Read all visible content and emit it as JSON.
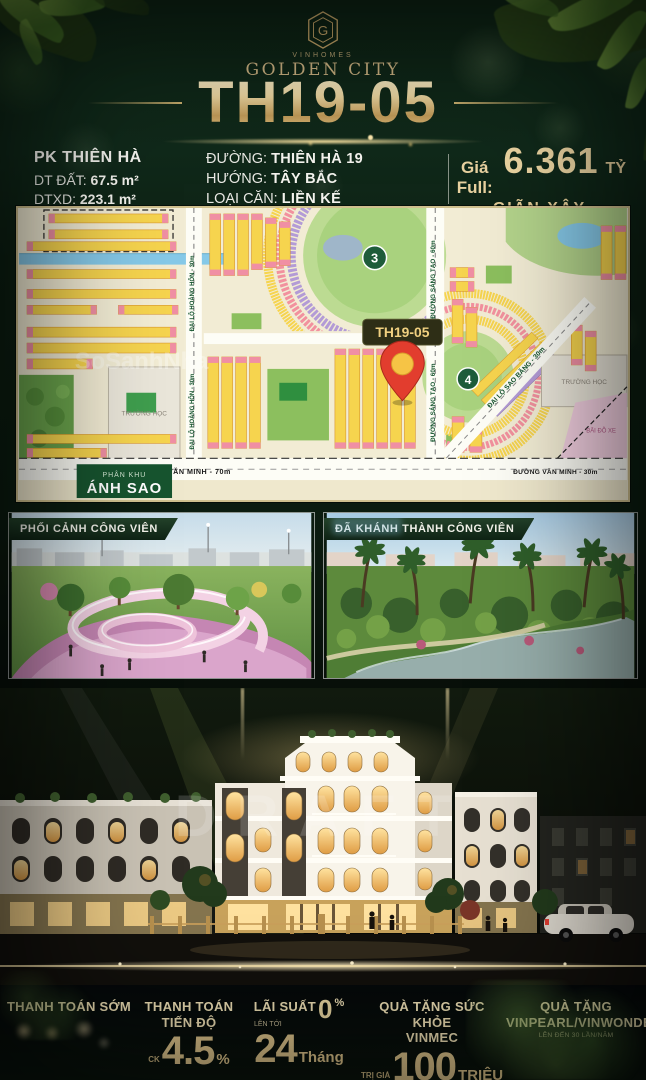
{
  "header": {
    "brand": "VINHOMES",
    "project": "GOLDEN CITY"
  },
  "title": "TH19-05",
  "info": {
    "zone": "PK THIÊN HÀ",
    "land_label": "DT ĐẤT:",
    "land_value": "67.5 m²",
    "build_label": "DTXD:",
    "build_value": "223.1 m²",
    "street_label": "ĐƯỜNG:",
    "street_value": "THIÊN HÀ 19",
    "direction_label": "HƯỚNG:",
    "direction_value": "TÂY BẮC",
    "type_label": "LOẠI CĂN:",
    "type_value": "LIỀN KẾ",
    "price_label": "Giá Full:",
    "price_value": "6.361",
    "price_unit": "TỶ",
    "price_note": "GIÃN XÂY"
  },
  "map": {
    "pin_label": "TH19-05",
    "zone_line1": "PHÂN KHU",
    "zone_line2": "ÁNH SAO",
    "park3": "3",
    "park4": "4",
    "road_van_minh_70": "ĐƯỜNG VĂN MINH - 70m",
    "road_van_minh_30": "ĐƯỜNG VĂN MINH - 30m",
    "road_sang_tao": "ĐƯỜNG SÁNG TẠO - 60m",
    "road_sao_bang": "ĐẠI LỘ SAO BĂNG - 30m",
    "road_hoang_hon": "ĐẠI LỘ HOÀNG HÔN - 30m",
    "school": "TRƯỜNG HỌC",
    "parking": "BÃI ĐỖ XE",
    "watermark": "SoSanhNha"
  },
  "cards": {
    "left_label": "PHỐI CẢNH CÔNG VIÊN",
    "right_label": "ĐÃ KHÁNH THÀNH CÔNG VIÊN"
  },
  "scene": {
    "watermark": "DRAFT"
  },
  "footer": {
    "col1_title": "THANH TOÁN SỚM",
    "col2_title1": "THANH TOÁN",
    "col2_title2": "TIẾN ĐỘ",
    "col2_prefix": "CK",
    "col2_big": "4.5",
    "col2_suffix": "%",
    "col3_title": "LÃI SUẤT",
    "col3_zero": "0",
    "col3_zero_pct": "%",
    "col3_small": "LÊN TỚI",
    "col3_big": "24",
    "col3_suffix": "Tháng",
    "col4_title1": "QUÀ TẶNG SỨC KHỎE",
    "col4_title2": "VINMEC",
    "col4_small": "TRỊ GIÁ",
    "col4_big": "100",
    "col4_suffix": "TRIỆU",
    "col5_title1": "QUÀ TẶNG",
    "col5_title2": "VINPEARL/VINWONDER",
    "col5_small": "LÊN ĐẾN 30 LẦN/NĂM"
  }
}
